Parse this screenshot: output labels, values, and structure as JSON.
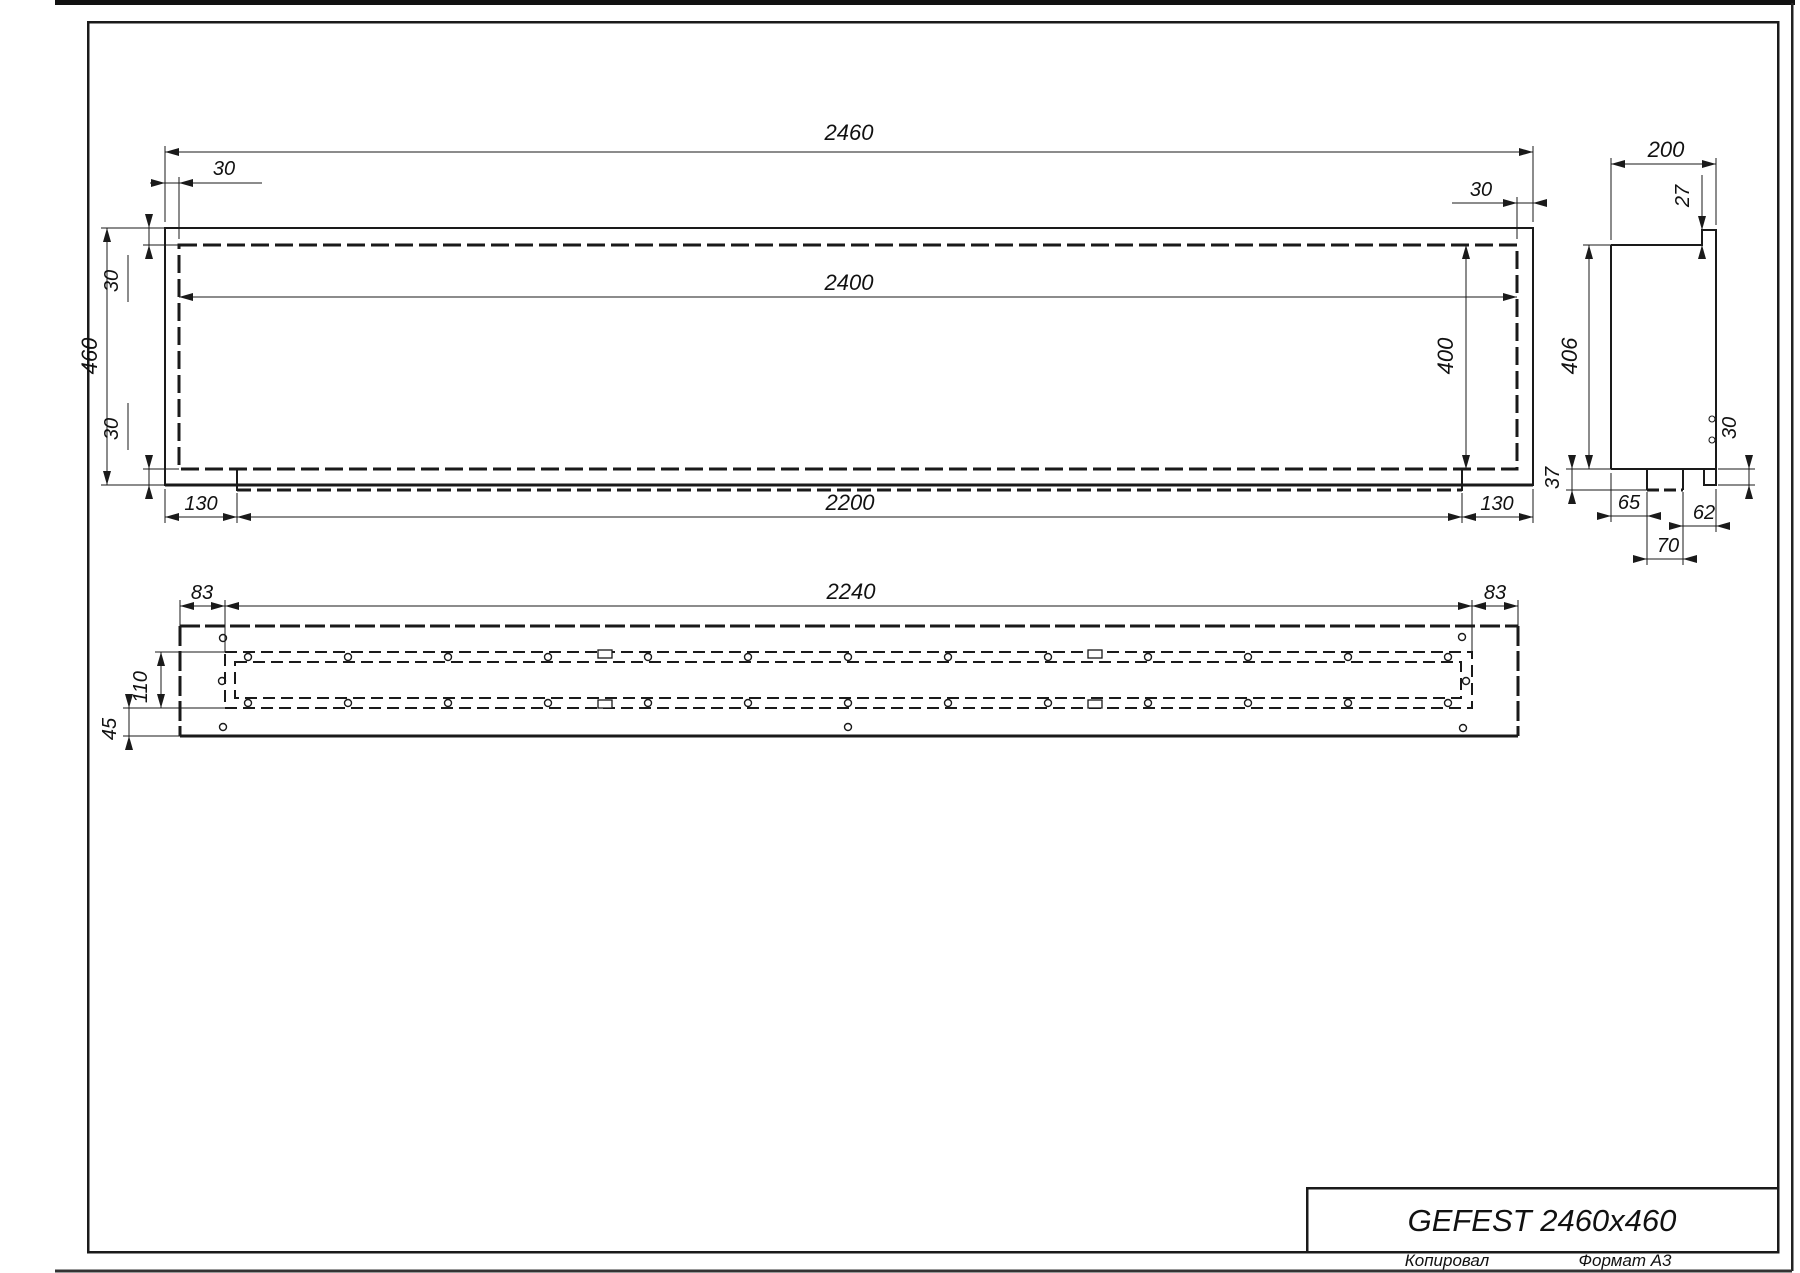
{
  "title_block": {
    "product": "GEFEST 2460x460"
  },
  "footer": {
    "copy_label": "Копировал",
    "format_label": "Формат А3"
  },
  "front_view": {
    "dims": {
      "total_width": "2460",
      "inner_width": "2400",
      "top_left_offset": "30",
      "top_right_offset": "30",
      "total_height": "460",
      "left_top_offset": "30",
      "left_bottom_offset": "30",
      "inner_height": "400",
      "bottom_left_offset": "130",
      "bottom_length": "2200",
      "bottom_right_offset": "130"
    }
  },
  "side_view": {
    "dims": {
      "depth": "200",
      "front_lip": "27",
      "height": "406",
      "foot_drop": "37",
      "bottom_flange": "30",
      "back_to_foot": "65",
      "foot_to_front": "62",
      "foot_width": "70"
    }
  },
  "bottom_view": {
    "dims": {
      "left_margin": "83",
      "slot_length": "2240",
      "right_margin": "83",
      "slot_width": "110",
      "front_offset": "45"
    }
  },
  "colors": {
    "ink": "#1a1a1a",
    "paper": "#ffffff"
  }
}
